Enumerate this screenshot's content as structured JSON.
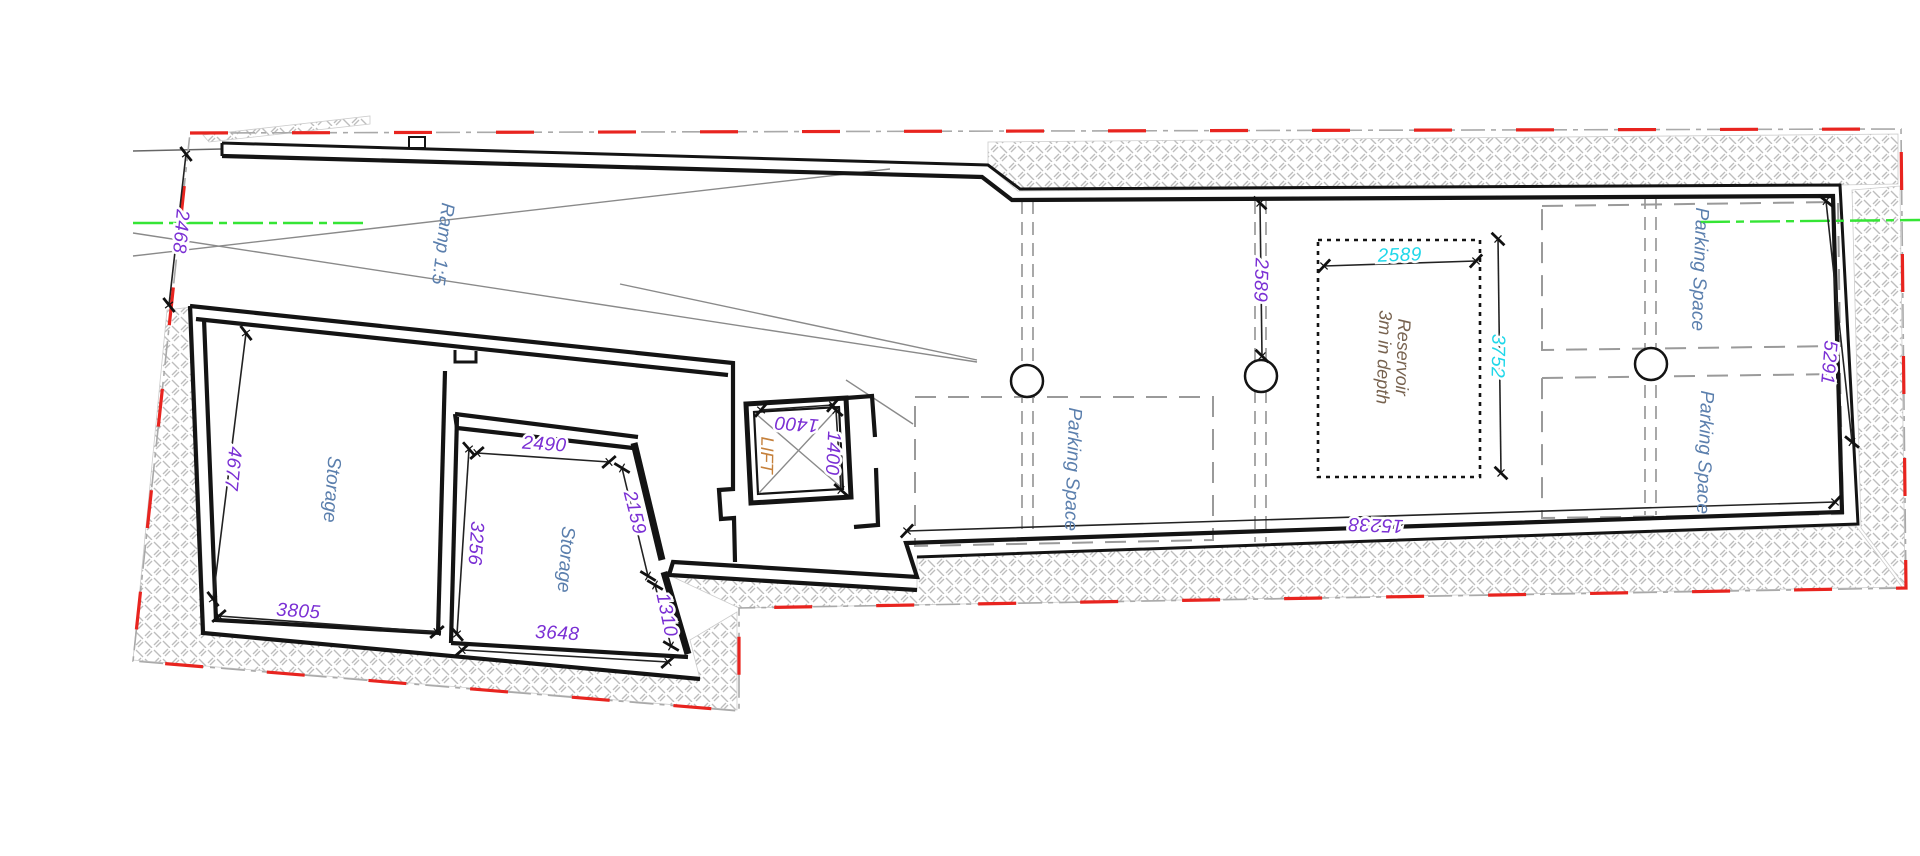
{
  "drawing": {
    "type": "basement floor plan",
    "background": "#ffffff"
  },
  "colors": {
    "dim_purple": "#7a2fd4",
    "dim_cyan": "#1fd7e9",
    "label_blue": "#5b7fad",
    "lift_orange": "#c5803b",
    "reservoir_brown": "#77624f",
    "boundary_red": "#e8241f",
    "boundary_gray": "#a9a9a9",
    "centerline_green": "#35e535",
    "wall_black": "#141414",
    "hatch_gray": "#bdbdbd",
    "grid_gray": "#9a9a9a"
  },
  "labels": {
    "ramp": "Ramp 1:5",
    "storage_1": "Storage",
    "storage_2": "Storage",
    "lift": "LIFT",
    "parking_middle": "Parking Space",
    "parking_top_right": "Parking Space",
    "parking_bottom_right": "Parking Space",
    "reservoir_line1": "Reservoir",
    "reservoir_line2": "3m in depth"
  },
  "dimensions": {
    "d2468": "2468",
    "d4677": "4677",
    "d3805": "3805",
    "d2490": "2490",
    "d3256": "3256",
    "d2159": "2159",
    "d1310": "1310",
    "d3648": "3648",
    "d1400t": "1400",
    "d1400r": "1400",
    "d2589p": "2589",
    "d2589c": "2589",
    "d3752": "3752",
    "d15238": "15238",
    "d5291": "5291"
  }
}
